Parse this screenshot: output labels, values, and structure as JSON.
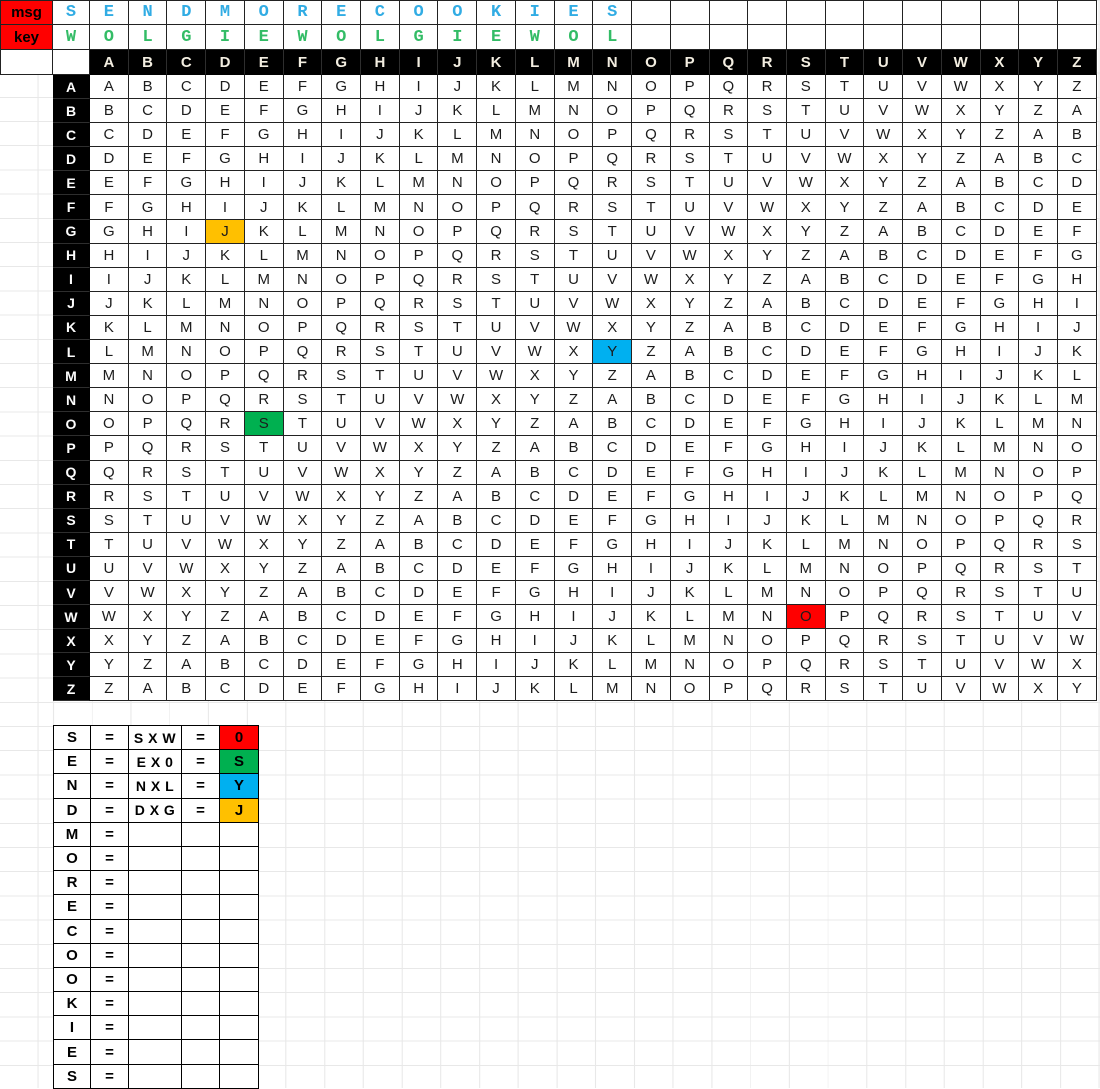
{
  "colors": {
    "label_bg": "#FF0000",
    "msg_text": "#31ACE4",
    "key_text": "#33BC66",
    "highlight_gold": "#FFC000",
    "highlight_blue": "#00B0F0",
    "highlight_green": "#00B050",
    "highlight_red": "#FF0000",
    "header_bg": "#000000"
  },
  "sheet": {
    "msg_row": {
      "label": "msg",
      "letters": [
        "S",
        "E",
        "N",
        "D",
        "M",
        "O",
        "R",
        "E",
        "C",
        "O",
        "O",
        "K",
        "I",
        "E",
        "S"
      ],
      "empty_cells": 12
    },
    "key_row": {
      "label": "key",
      "letters": [
        "W",
        "O",
        "L",
        "G",
        "I",
        "E",
        "W",
        "O",
        "L",
        "G",
        "I",
        "E",
        "W",
        "O",
        "L"
      ],
      "empty_cells": 12
    }
  },
  "vigenere": {
    "col_headers": "ABCDEFGHIJKLMNOPQRSTUVWXYZ",
    "row_headers": "ABCDEFGHIJKLMNOPQRSTUVWXYZ",
    "rows": [
      "ABCDEFGHIJKLMNOPQRSTUVWXYZ",
      "BCDEFGHIJKLMNOPQRSTUVWXYZA",
      "CDEFGHIJKLMNOPQRSTUVWXYZAB",
      "DEFGHIJKLMNOPQRSTUVWXYZABC",
      "EFGHIJKLMNOPQRSTUVWXYZABCD",
      "FGHIJKLMNOPQRSTUVWXYZABCDE",
      "GHIJKLMNOPQRSTUVWXYZABCDEF",
      "HIJKLMNOPQRSTUVWXYZABCDEFG",
      "IJKLMNOPQRSTUVWXYZABCDEFGH",
      "JKLMNOPQRSTUVWXYZABCDEFGHI",
      "KLMNOPQRSTUVWXYZABCDEFGHIJ",
      "LMNOPQRSTUVWXYZABCDEFGHIJK",
      "MNOPQRSTUVWXYZABCDEFGHIJKL",
      "NOPQRSTUVWXYZABCDEFGHIJKLM",
      "OPQRSTUVWXYZABCDEFGHIJKLMN",
      "PQRSTUVWXYZABCDEFGHIJKLMNO",
      "QRSTUVWXYZABCDEFGHIJKLMNOP",
      "RSTUVWXYZABCDEFGHIJKLMNOPQ",
      "STUVWXYZABCDEFGHIJKLMNOPQR",
      "TUVWXYZABCDEFGHIJKLMNOPQRS",
      "UVWXYZABCDEFGHIJKLMNOPQRST",
      "VWXYZABCDEFGHIJKLMNOPQRSTU",
      "WXYZABCDEFGHIJKLMNOPQRSTUV",
      "XYZABCDEFGHIJKLMNOPQRSTUVW",
      "YZABCDEFGHIJKLMNOPQRSTUVWX",
      "ZABCDEFGHIJKLMNOPQRSTUVWXY"
    ],
    "highlights": [
      {
        "row": "G",
        "col": "D",
        "letter": "J",
        "color_key": "highlight_gold"
      },
      {
        "row": "L",
        "col": "N",
        "letter": "Y",
        "color_key": "highlight_blue"
      },
      {
        "row": "O",
        "col": "E",
        "letter": "S",
        "color_key": "highlight_green"
      },
      {
        "row": "W",
        "col": "S",
        "letter": "O",
        "color_key": "highlight_red"
      }
    ]
  },
  "worksheet": {
    "rows": [
      {
        "letter": "S",
        "eq": "=",
        "formula": "S X W",
        "eq2": "=",
        "result": "0",
        "result_color_key": "highlight_red"
      },
      {
        "letter": "E",
        "eq": "=",
        "formula": "E X 0",
        "eq2": "=",
        "result": "S",
        "result_color_key": "highlight_green"
      },
      {
        "letter": "N",
        "eq": "=",
        "formula": "N X L",
        "eq2": "=",
        "result": "Y",
        "result_color_key": "highlight_blue"
      },
      {
        "letter": "D",
        "eq": "=",
        "formula": "D X G",
        "eq2": "=",
        "result": "J",
        "result_color_key": "highlight_gold"
      },
      {
        "letter": "M",
        "eq": "=",
        "formula": "",
        "eq2": "",
        "result": ""
      },
      {
        "letter": "O",
        "eq": "=",
        "formula": "",
        "eq2": "",
        "result": ""
      },
      {
        "letter": "R",
        "eq": "=",
        "formula": "",
        "eq2": "",
        "result": ""
      },
      {
        "letter": "E",
        "eq": "=",
        "formula": "",
        "eq2": "",
        "result": ""
      },
      {
        "letter": "C",
        "eq": "=",
        "formula": "",
        "eq2": "",
        "result": ""
      },
      {
        "letter": "O",
        "eq": "=",
        "formula": "",
        "eq2": "",
        "result": ""
      },
      {
        "letter": "O",
        "eq": "=",
        "formula": "",
        "eq2": "",
        "result": ""
      },
      {
        "letter": "K",
        "eq": "=",
        "formula": "",
        "eq2": "",
        "result": ""
      },
      {
        "letter": "I",
        "eq": "=",
        "formula": "",
        "eq2": "",
        "result": ""
      },
      {
        "letter": "E",
        "eq": "=",
        "formula": "",
        "eq2": "",
        "result": ""
      },
      {
        "letter": "S",
        "eq": "=",
        "formula": "",
        "eq2": "",
        "result": ""
      }
    ]
  }
}
